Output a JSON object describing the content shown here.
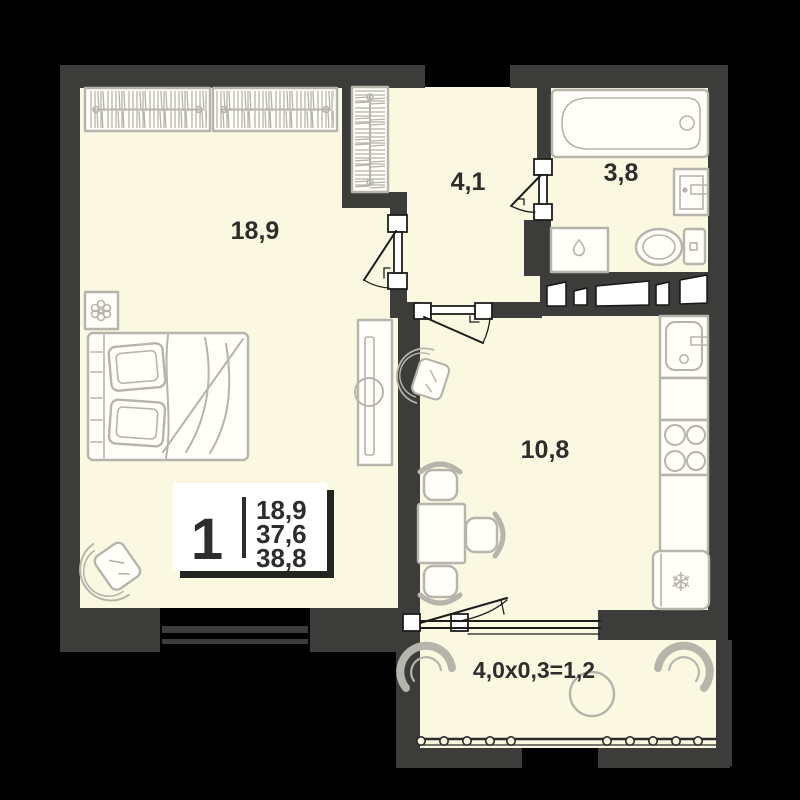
{
  "plan": {
    "type": "apartment-floor-plan",
    "legend": {
      "rooms_count": "1",
      "living_area": "18,9",
      "area_no_balcony": "37,6",
      "total_area": "38,8"
    },
    "rooms": {
      "living": {
        "label": "18,9"
      },
      "hallway": {
        "label": "4,1"
      },
      "bathroom": {
        "label": "3,8"
      },
      "kitchen": {
        "label": "10,8"
      },
      "balcony": {
        "label": "4,0x0,3=1,2"
      }
    },
    "icons": {
      "fridge_snowflake": "❄"
    },
    "colors": {
      "background": "#000000",
      "wall": "#3c3c3a",
      "floor": "#fbf8e2",
      "furniture_stroke": "#b5b5ac",
      "label_text": "#2d2d2b",
      "legend_bg": "#ffffff"
    }
  }
}
